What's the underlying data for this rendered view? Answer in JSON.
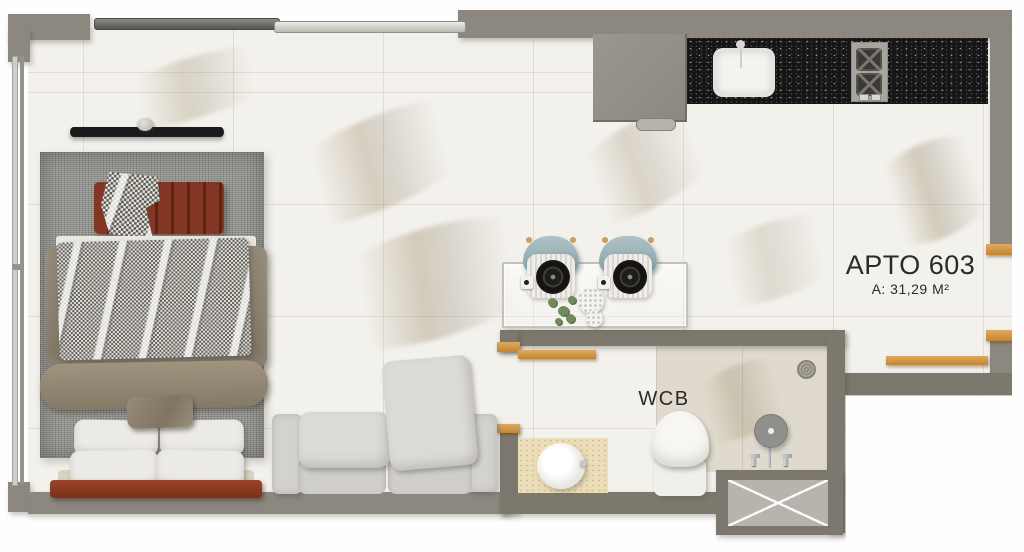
{
  "plan": {
    "unit_label": "APTO 603",
    "area_label": "A: 31,29 M²",
    "bathroom_label": "WCB"
  },
  "colors": {
    "wall_gray": "#8c8880",
    "wall_dark_gray": "#7c786e",
    "floor_marble": "#f3f1ec",
    "wood_accent": "#d0954a",
    "kitchen_countertop": "#161616",
    "chair_teal": "#9ab3b8",
    "duvet_taupe": "#8b8171",
    "bench_rust": "#7a3322",
    "headboard_wood": "#8f3f26",
    "sofa_gray": "#d6d5d1",
    "vanity_travertine": "#ecddb9",
    "shaft_fill": "#b7b4ad",
    "label_text": "#2c2a27"
  },
  "furniture_icons": [
    "tv-icon",
    "bench-icon",
    "bed-icon",
    "rug-icon",
    "sofa-icon",
    "dining-table-icon",
    "dining-chair-icon",
    "plant-icon",
    "refrigerator-icon",
    "kitchen-sink-icon",
    "cooktop-icon",
    "countertop-icon",
    "toilet-icon",
    "vanity-sink-icon",
    "shower-head-icon",
    "shower-faucet-icon",
    "floor-drain-icon",
    "service-shaft-icon",
    "entry-door-icon",
    "bathroom-door-icon",
    "sliding-window-icon",
    "side-window-icon"
  ]
}
